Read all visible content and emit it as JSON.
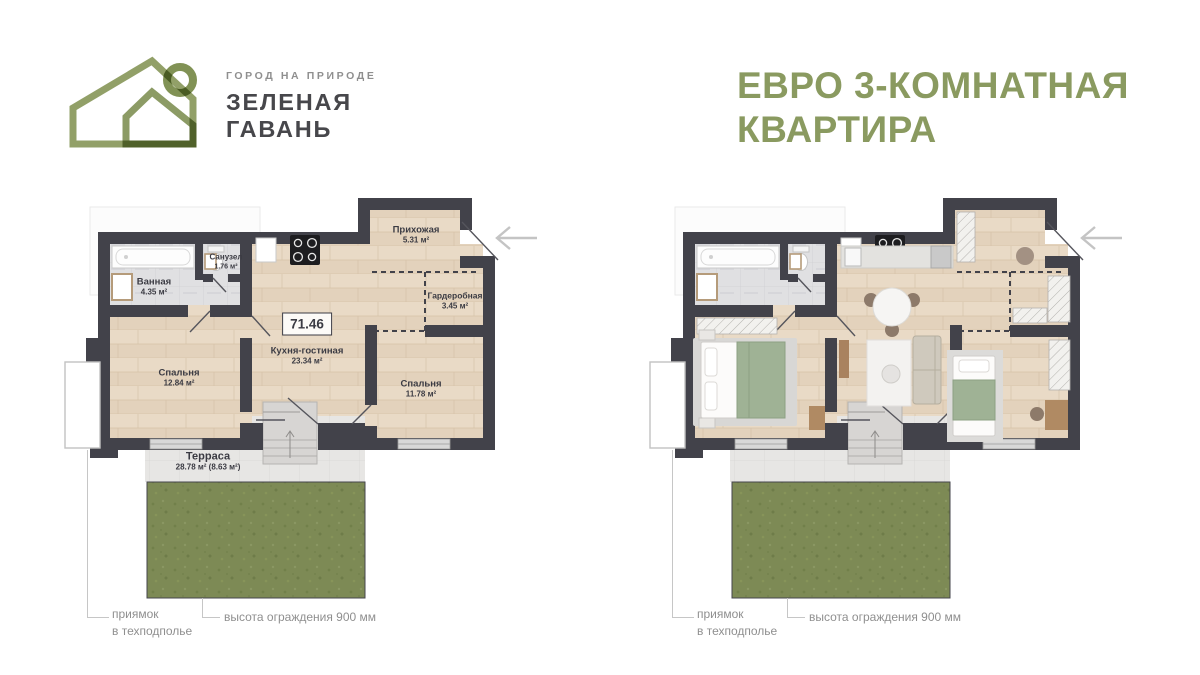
{
  "brand": {
    "tagline": "ГОРОД НА ПРИРОДЕ",
    "name_line1": "ЗЕЛЕНАЯ",
    "name_line2": "ГАВАНЬ"
  },
  "title": {
    "line1": "ЕВРО 3-КОМНАТНАЯ",
    "line2": "КВАРТИРА"
  },
  "plan": {
    "total_area": "71.46",
    "rooms": [
      {
        "name": "Ванная",
        "area": "4.35 м²"
      },
      {
        "name": "Санузел",
        "area": "1.76 м²"
      },
      {
        "name": "Прихожая",
        "area": "5.31 м²"
      },
      {
        "name": "Гардеробная",
        "area": "3.45 м²"
      },
      {
        "name": "Кухня-гостиная",
        "area": "23.34 м²"
      },
      {
        "name": "Спальня",
        "area": "12.84 м²"
      },
      {
        "name": "Спальня",
        "area": "11.78 м²"
      },
      {
        "name": "Терраса",
        "area": "28.78 м² (8.63 м²)"
      }
    ]
  },
  "annotations": {
    "pit_line1": "приямок",
    "pit_line2": "в техподполье",
    "fence": "высота ограждения 900 мм"
  },
  "colors": {
    "accent_green": "#8a9a60",
    "wall_dark": "#42424a",
    "grass_green": "#7d8a55",
    "label_dark": "#3b3b43",
    "annotation_gray": "#8f8f8f"
  },
  "icons": {
    "logo": "green-harbor-house-logo",
    "entrance_arrow": "left-arrow"
  }
}
